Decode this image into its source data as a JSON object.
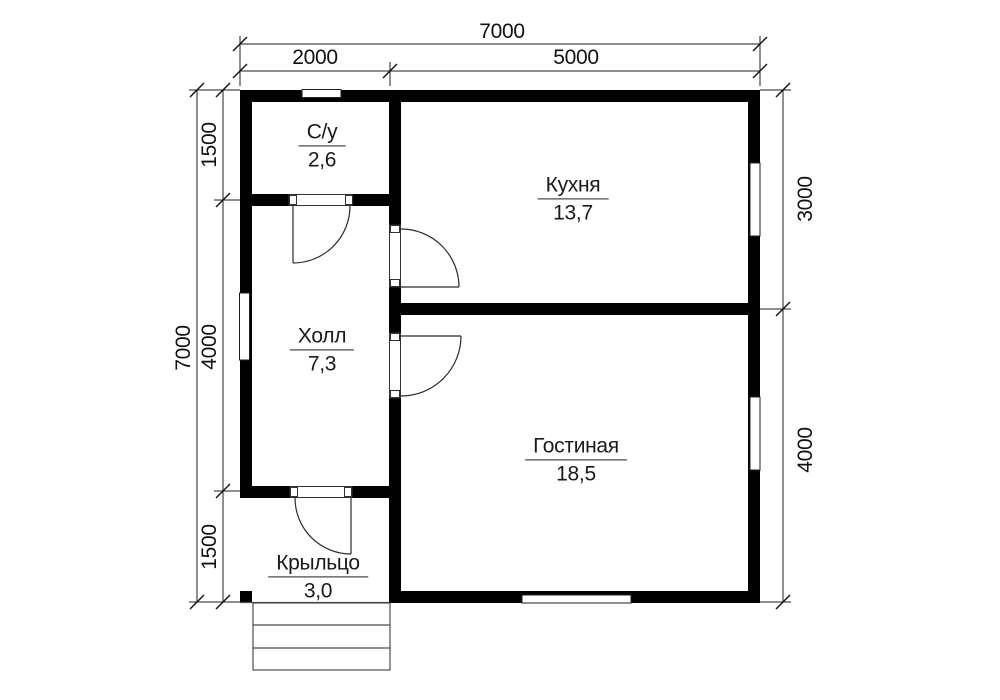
{
  "canvas": {
    "width": 1000,
    "height": 700,
    "background": "#ffffff"
  },
  "colors": {
    "wall": "#000000",
    "thin_line": "#1f1f1f",
    "steps_line": "#4d4d4d",
    "text": "#1a1a1a"
  },
  "rooms": [
    {
      "id": "bathroom",
      "name": "С/у",
      "area": "2,6"
    },
    {
      "id": "kitchen",
      "name": "Кухня",
      "area": "13,7"
    },
    {
      "id": "hall",
      "name": "Холл",
      "area": "7,3"
    },
    {
      "id": "living-room",
      "name": "Гостиная",
      "area": "18,5"
    },
    {
      "id": "porch",
      "name": "Крыльцо",
      "area": "3,0"
    }
  ],
  "dimensions": {
    "top_total": "7000",
    "top_seg1": "2000",
    "top_seg2": "5000",
    "left_total": "7000",
    "left_seg1": "1500",
    "left_seg2": "4000",
    "left_seg3": "1500",
    "right_seg1": "3000",
    "right_seg2": "4000"
  }
}
